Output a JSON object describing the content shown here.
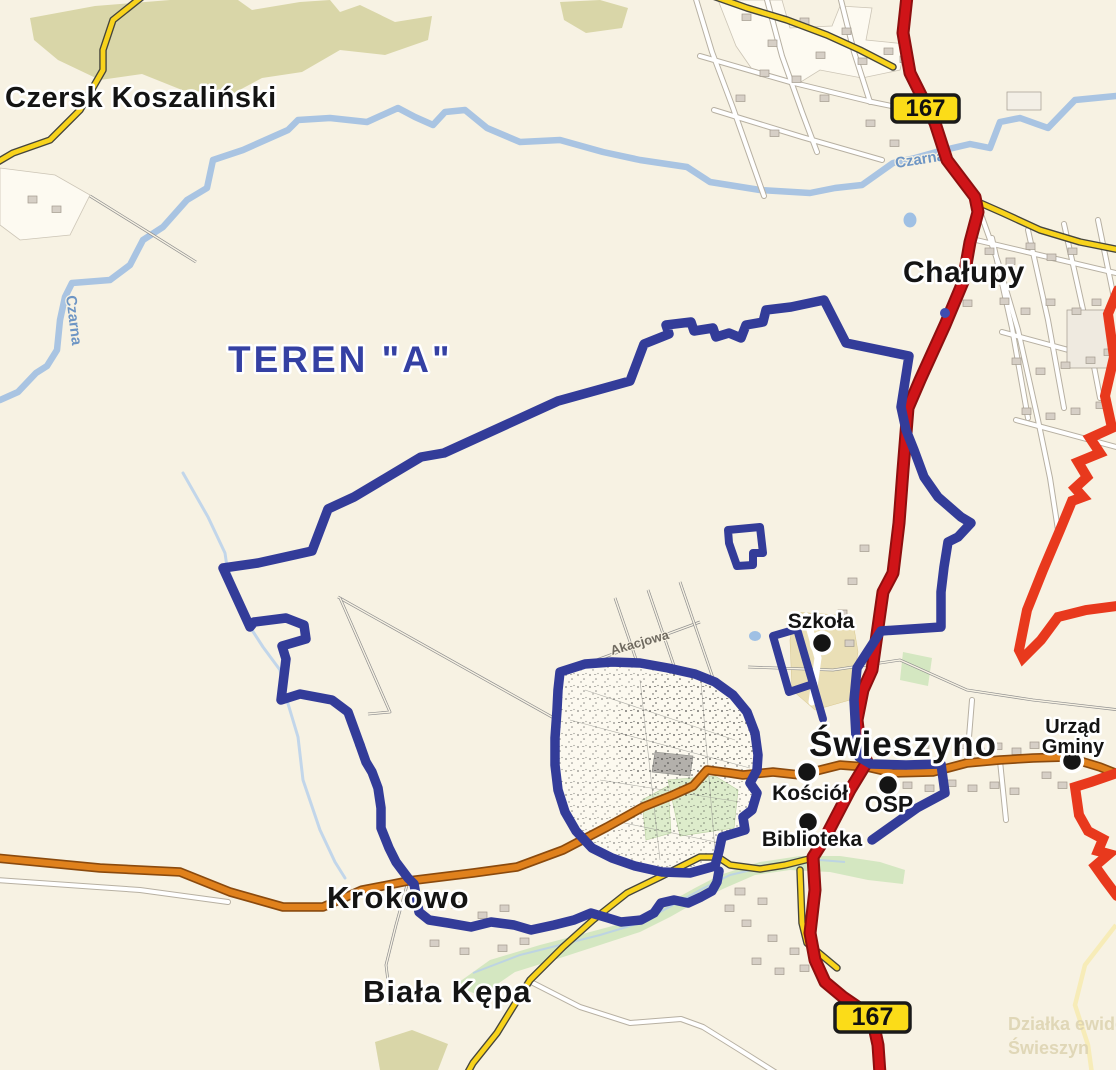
{
  "map": {
    "region_label": "TEREN \"A\"",
    "route_number": "167",
    "places": {
      "czersk_koszalinski": "Czersk Koszaliński",
      "chalupy": "Chałupy",
      "swieszyno": "Świeszyno",
      "krokowo": "Krokowo",
      "biala_kepa": "Biała Kępa"
    },
    "pois": {
      "szkola": "Szkoła",
      "kosciol": "Kościół",
      "osp": "OSP",
      "biblioteka": "Biblioteka",
      "urzad_gminy_line1": "Urząd",
      "urzad_gminy_line2": "Gminy"
    },
    "waterways": {
      "czarna_lower": "Czarna",
      "czarna_upper": "Czarna"
    },
    "streets": {
      "akacjowa": "Akacjowa"
    },
    "watermark": {
      "line1": "Działka ewide",
      "line2": "Świeszyn"
    },
    "colors": {
      "background": "#f7f2e3",
      "boundary_blue": "#333c99",
      "boundary_red": "#e8391d",
      "road_red": "#cf1418",
      "road_orange": "#e0811c",
      "road_yellow": "#f8d31c",
      "river_blue": "#a9c4e2",
      "forest_olive": "#d9d6a8",
      "valley_green": "#cfe6bd",
      "shield_yellow": "#fbdc18",
      "region_label_blue": "#3440a3"
    }
  }
}
